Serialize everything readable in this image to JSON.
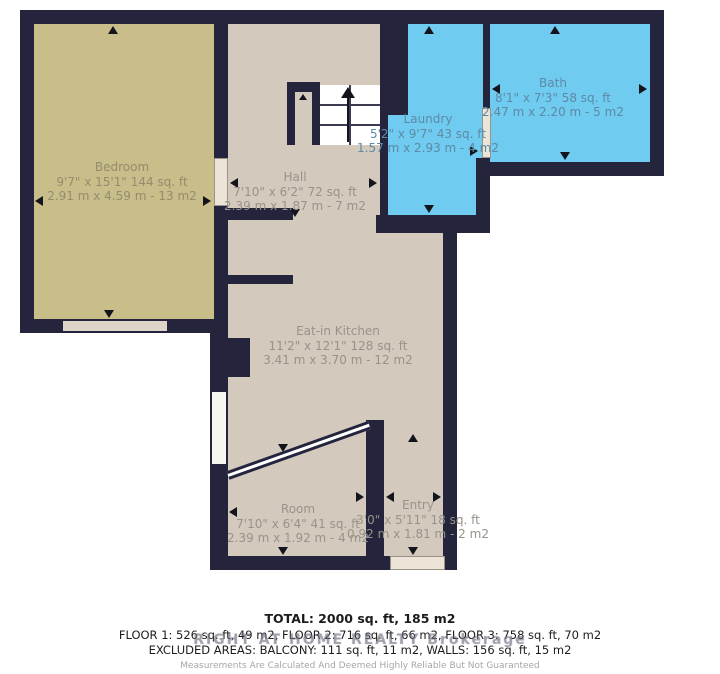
{
  "rooms": {
    "bedroom": {
      "name": "Bedroom",
      "dims_ft": "9'7\" x 15'1\" 144 sq. ft",
      "dims_m": "2.91 m x 4.59 m - 13 m2"
    },
    "hall": {
      "name": "Hall",
      "dims_ft": "7'10\" x 6'2\" 72 sq. ft",
      "dims_m": "2.39 m x 1.87 m - 7 m2"
    },
    "laundry": {
      "name": "Laundry",
      "dims_ft": "5'2\" x 9'7\" 43 sq. ft",
      "dims_m": "1.57 m x 2.93 m - 4 m2"
    },
    "bath": {
      "name": "Bath",
      "dims_ft": "8'1\" x 7'3\" 58 sq. ft",
      "dims_m": "2.47 m x 2.20 m - 5 m2"
    },
    "kitchen": {
      "name": "Eat-in Kitchen",
      "dims_ft": "11'2\" x 12'1\" 128 sq. ft",
      "dims_m": "3.41 m x 3.70 m - 12 m2"
    },
    "room": {
      "name": "Room",
      "dims_ft": "7'10\" x 6'4\" 41 sq. ft",
      "dims_m": "2.39 m x 1.92 m - 4 m2"
    },
    "entry": {
      "name": "Entry",
      "dims_ft": "3'0\" x 5'11\" 18 sq. ft",
      "dims_m": "0.92 m x 1.81 m - 2 m2"
    }
  },
  "summary": {
    "total": "TOTAL: 2000 sq. ft, 185 m2",
    "floors": "FLOOR 1: 526 sq. ft, 49 m2, FLOOR 2: 716 sq. ft, 66 m2, FLOOR 3: 758 sq. ft, 70 m2",
    "excluded": "EXCLUDED AREAS: BALCONY: 111 sq. ft, 11 m2, WALLS: 156 sq. ft, 15 m2",
    "disclaimer": "Measurements Are Calculated And Deemed Highly Reliable But Not Guaranteed"
  },
  "watermark": "RIGHT AT HOME REALTY Brokerage",
  "colors": {
    "wall": "#24243c",
    "bedroom_fill": "#c9bd8a",
    "dry_room_fill": "#d3c9bd",
    "wet_room_fill": "#6fcbf0",
    "label_text": "#98938a"
  }
}
